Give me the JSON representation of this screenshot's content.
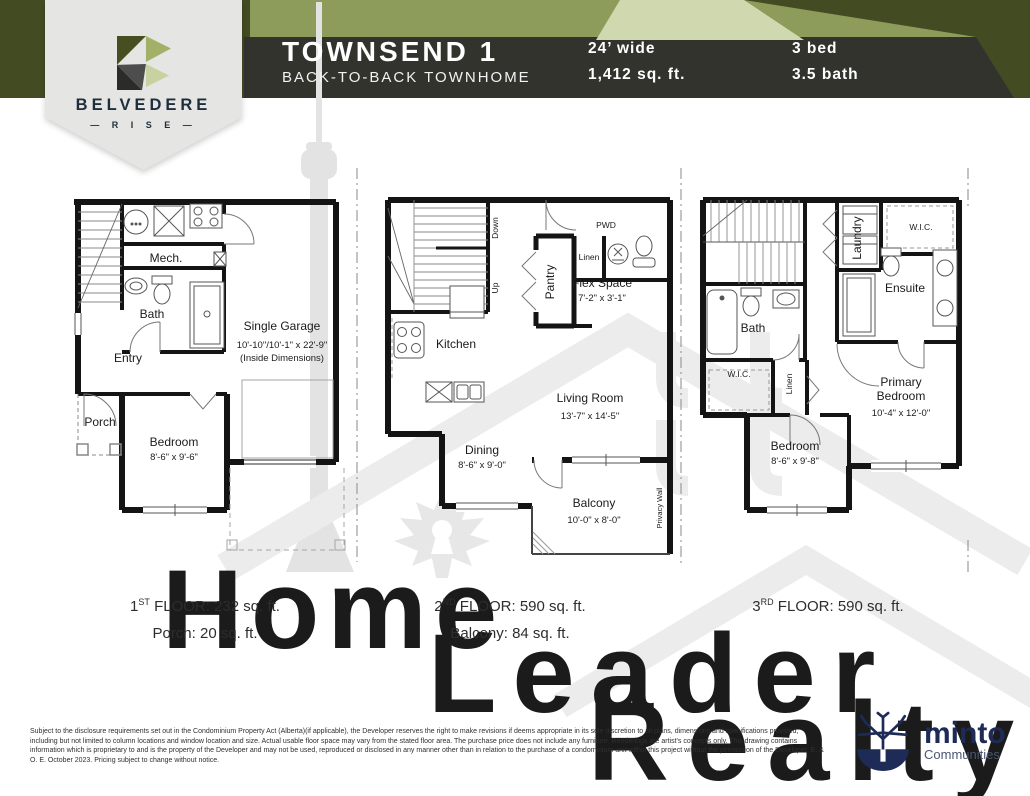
{
  "header": {
    "title": "TOWNSEND 1",
    "subtitle": "BACK-TO-BACK TOWNHOME",
    "width": "24’ wide",
    "area": "1,412 sq. ft.",
    "beds": "3 bed",
    "baths": "3.5 bath",
    "colors": {
      "dark_olive": "#434b22",
      "mid_olive": "#8d9b5b",
      "pale_sage": "#cfd8ae",
      "charcoal": "#32332c"
    }
  },
  "brand": {
    "name": "BELVEDERE",
    "rise": "— R I S E —"
  },
  "plan1": {
    "mech": "Mech.",
    "bath": "Bath",
    "entry": "Entry",
    "porch": "Porch",
    "garage": "Single Garage",
    "garage_dim": "10'-10\"/10'-1\" x 22'-9\"",
    "garage_dim2": "(Inside Dimensions)",
    "bedroom": "Bedroom",
    "bedroom_dim": "8'-6\" x 9'-6\""
  },
  "plan2": {
    "down": "Down",
    "up": "Up",
    "pantry": "Pantry",
    "linen": "Linen",
    "pwd": "PWD",
    "flex": "Flex Space",
    "flex_dim": "7'-2\" x 3'-1\"",
    "kitchen": "Kitchen",
    "living": "Living Room",
    "living_dim": "13'-7\" x 14'-5\"",
    "dining": "Dining",
    "dining_dim": "8'-6\" x 9'-0\"",
    "balcony": "Balcony",
    "balcony_dim": "10'-0\" x 8'-0\"",
    "privacy": "Privacy Wall"
  },
  "plan3": {
    "laundry": "Laundry",
    "wic_top": "W.I.C.",
    "ensuite": "Ensuite",
    "bath": "Bath",
    "wic_lower": "W.I.C.",
    "linen": "Linen",
    "primary_l1": "Primary",
    "primary_l2": "Bedroom",
    "primary_dim": "10'-4\" x 12'-0\"",
    "bedroom": "Bedroom",
    "bedroom_dim": "8'-6\" x 9'-8\""
  },
  "floors": [
    {
      "num": "1",
      "sup": "ST",
      "rest": " FLOOR: 232 sq. ft.",
      "extra": "Porch: 20 sq. ft."
    },
    {
      "num": "2",
      "sup": "ND",
      "rest": " FLOOR: 590 sq. ft.",
      "extra": "Balcony: 84 sq. ft."
    },
    {
      "num": "3",
      "sup": "RD",
      "rest": " FLOOR: 590 sq. ft.",
      "extra": ""
    }
  ],
  "watermark": {
    "w1": "Home",
    "w2": "Leader",
    "w3": "Realty"
  },
  "minto": {
    "name": "minto",
    "tagline": "Communities"
  },
  "disclaimer": "Subject to the disclosure requirements set out in the Condominium Property Act (Alberta)(if applicable), the Developer reserves the right to make revisions if deems appropriate in its sole discretion to all plans, dimensions and specifications provided, including but not limited to column locations and window location and size. Actual usable floor space may vary from the stated floor area. The purchase price does not include any furniture. Renderings are artist's concepts only. This drawing contains information which is proprietary to and is the property of the Developer and may not be used, reproduced or disclosed in any manner other than in relation to the purchase of a condominium unit within this project without the permission of the Developer. E. & O. E. October 2023. Pricing subject to change without notice."
}
